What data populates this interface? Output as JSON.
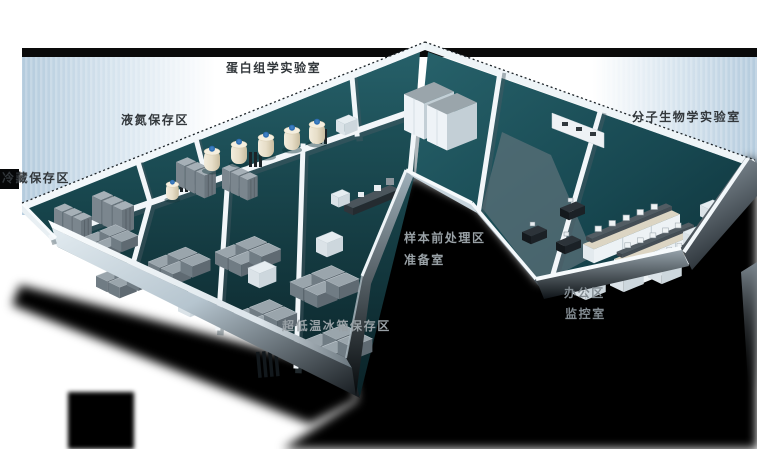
{
  "areas": [
    {
      "id": "proteomics-lab",
      "label": "蛋白组学实验室"
    },
    {
      "id": "liquid-nitrogen-storage",
      "label": "液氮保存区"
    },
    {
      "id": "cold-storage",
      "label": "冷藏保存区"
    },
    {
      "id": "molecular-biology-lab",
      "label": "分子生物学实验室"
    },
    {
      "id": "sample-pretreatment-area",
      "label": "样本前处理区"
    },
    {
      "id": "preparation-room",
      "label": "准备室"
    },
    {
      "id": "office-area",
      "label": "办公区"
    },
    {
      "id": "monitoring-room",
      "label": "监控室"
    },
    {
      "id": "ult-freezer-storage",
      "label": "超低温冰箱保存区"
    }
  ],
  "colors": {
    "floor_teal": "#1d5058",
    "backdrop_blue": "#b4cbdd",
    "wall_white": "#f2f7fa",
    "shadow_black": "#000000",
    "label_dark": "#32373b",
    "label_light": "#99a1a6",
    "tank_cream": "#e9e1cd",
    "equipment_gray": "#8d989f"
  }
}
